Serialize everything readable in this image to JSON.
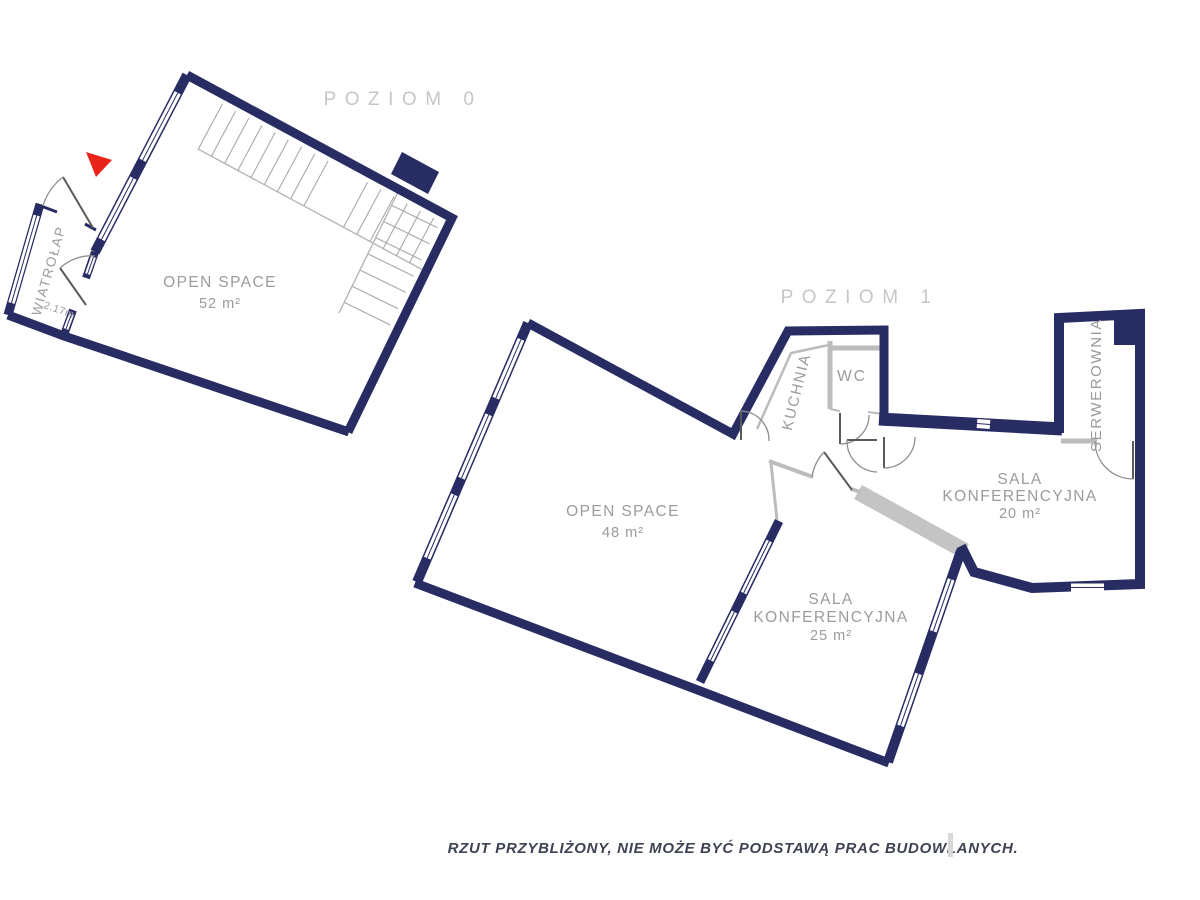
{
  "colors": {
    "wall_navy": "#272c63",
    "wall_gray": "#bcbcbc",
    "band_gray": "#c4c4c4",
    "title_gray": "#c6c6c8",
    "label_gray": "#9b9b9f",
    "stair_gray": "#a8a8a8",
    "stair_edge": "#b6b6b6",
    "door_gray": "#8f8f8f",
    "door_leaf": "#5a5a5a",
    "red_marker": "#e8231a",
    "note_color": "#3e4354",
    "caret_gray": "#d8d8d8"
  },
  "level0": {
    "title": "POZIOM 0",
    "open_space": {
      "name": "OPEN SPACE",
      "area": "52 m²"
    },
    "wiatrolap": {
      "name": "WIATROŁAP",
      "dim": "2.17m"
    }
  },
  "level1": {
    "title": "POZIOM 1",
    "open_space": {
      "name": "OPEN SPACE",
      "area": "48 m²"
    },
    "kuchnia": "KUCHNIA",
    "wc": "WC",
    "serwerownia": "SERWEROWNIA",
    "sala20": {
      "line1": "SALA",
      "line2": "KONFERENCYJNA",
      "area": "20 m²"
    },
    "sala25": {
      "line1": "SALA",
      "line2": "KONFERENCYJNA",
      "area": "25 m²"
    }
  },
  "footer": {
    "note": "RZUT PRZYBLIŻONY, NIE MOŻE BYĆ PODSTAWĄ PRAC BUDOWLANYCH."
  }
}
